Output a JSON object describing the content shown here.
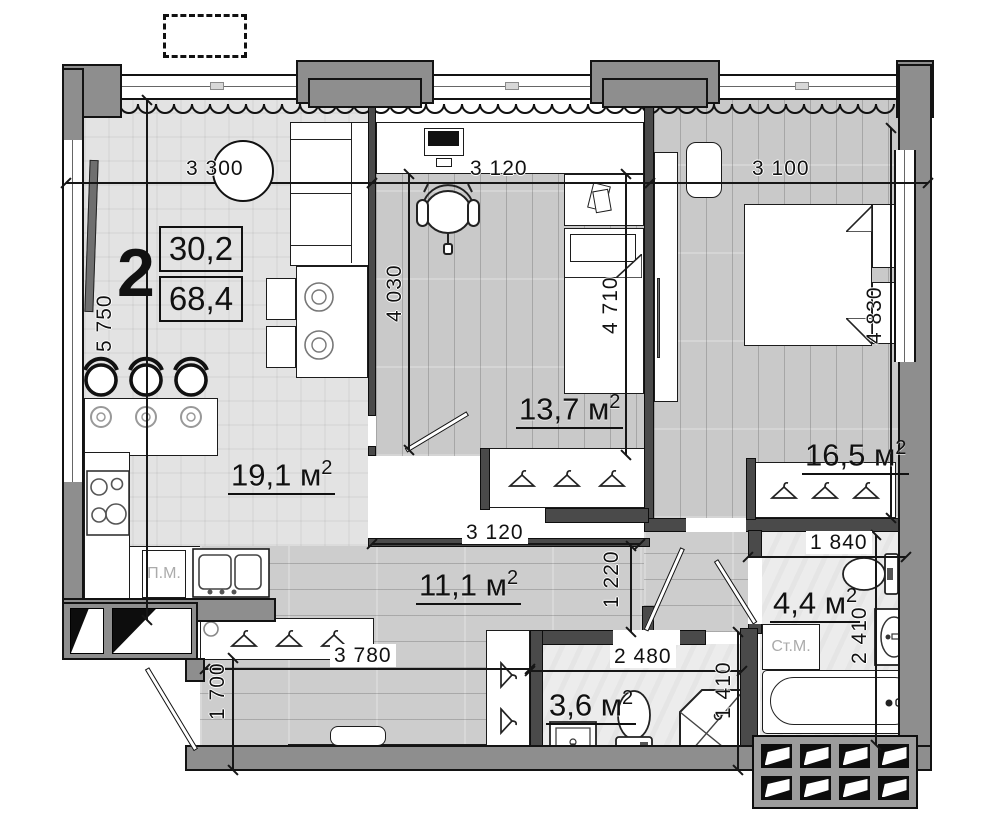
{
  "title_block": {
    "rooms_count": "2",
    "area_top": "30,2",
    "area_bottom": "68,4"
  },
  "room_labels": {
    "living": {
      "area": "19,1 м",
      "sup": "2"
    },
    "study": {
      "area": "13,7 м",
      "sup": "2"
    },
    "master": {
      "area": "16,5 м",
      "sup": "2"
    },
    "hall": {
      "area": "11,1 м",
      "sup": "2"
    },
    "bath_large": {
      "area": "4,4 м",
      "sup": "2"
    },
    "bath_small": {
      "area": "3,6 м",
      "sup": "2"
    }
  },
  "dimensions": {
    "top_left": "3 300",
    "top_middle": "3 120",
    "top_right": "3 100",
    "left_side": "5 750",
    "study_depth": "4 030",
    "study_bed": "4 710",
    "master_depth": "4 830",
    "hall_top": "3 120",
    "corridor_width": "1 220",
    "bath_large_width": "1 840",
    "bath_large_depth": "2 410",
    "hall_bottom": "3 780",
    "entry_depth": "1 700",
    "bath_small_width": "2 480",
    "shower_side": "1 410"
  },
  "appliances": {
    "dishwasher": "П.М.",
    "washer": "Ст.М."
  },
  "colors": {
    "wall_fill": "#8e8e8e",
    "wall_dark": "#4a4a4a",
    "line": "#111111",
    "floor_wood": "#cccccc",
    "floor_living": "#e3e3e3",
    "floor_bath": "#ececec"
  }
}
